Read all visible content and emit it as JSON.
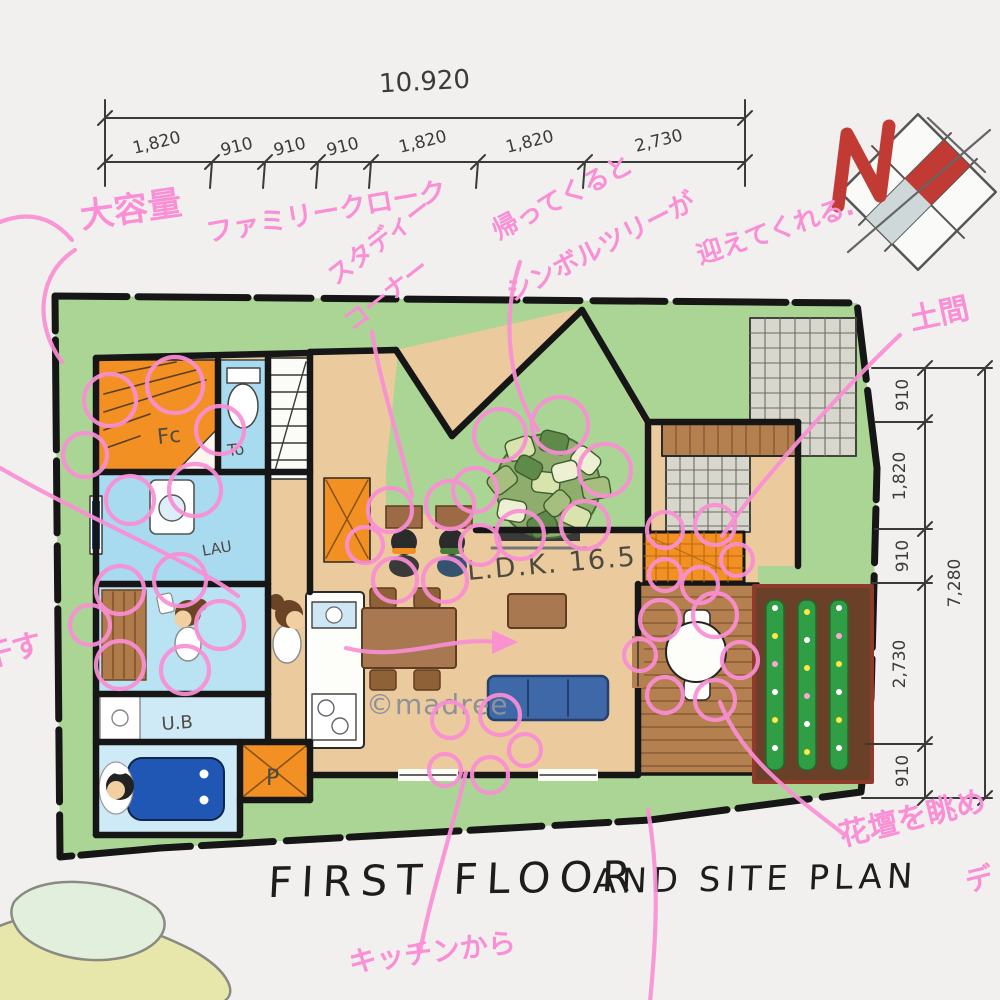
{
  "meta": {
    "watermark": "©madree",
    "title_part1": "FIRST FLOOR",
    "title_part2": "AND SITE PLAN"
  },
  "north_indicator": {
    "label": "N"
  },
  "dimensions": {
    "top": {
      "total": "10.920",
      "segments": [
        "1,820",
        "910",
        "910",
        "910",
        "1,820",
        "1,820",
        "2,730"
      ]
    },
    "right": {
      "total": "7,280",
      "segments": [
        "910",
        "1,820",
        "910",
        "2,730",
        "910"
      ]
    }
  },
  "rooms": {
    "family_closet": "Fc",
    "toilet": "To",
    "laundry": "LAU",
    "unit_bath": "U.B",
    "pantry": "P",
    "ldk": "L.D.K. 16.5"
  },
  "annotations": [
    {
      "id": "large-capacity",
      "text": "大容量"
    },
    {
      "id": "family-cloak",
      "text": "ファミリークローク"
    },
    {
      "id": "study-line1",
      "text": "スタディー"
    },
    {
      "id": "study-line2",
      "text": "コーナー"
    },
    {
      "id": "welcome-line1",
      "text": "帰ってくると"
    },
    {
      "id": "welcome-line2",
      "text": "シンボルツリーが"
    },
    {
      "id": "welcome-line3",
      "text": "迎えてくれる."
    },
    {
      "id": "doma",
      "text": "土間"
    },
    {
      "id": "flowerbed",
      "text": "花壇を眺め"
    },
    {
      "id": "deck-partial",
      "text": "デ"
    },
    {
      "id": "kitchen-from",
      "text": "キッチンから"
    },
    {
      "id": "left-partial",
      "text": "干す"
    }
  ],
  "colors": {
    "pink_marker": "#fa8fd5",
    "lawn": "#abd595",
    "floor": "#ebcb9e",
    "orange": "#f29024",
    "light_blue": "#a8daf0",
    "wood": "#b5804f",
    "north_red": "#c13a33",
    "wall": "#161616"
  }
}
